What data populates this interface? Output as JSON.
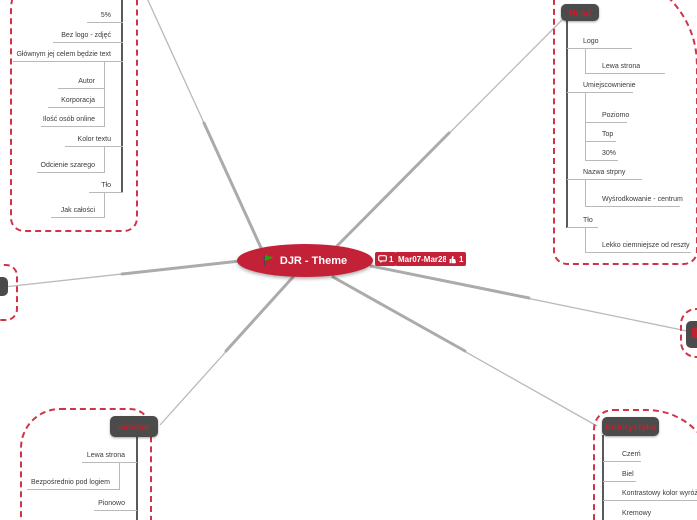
{
  "colors": {
    "accent_red": "#c32138",
    "node_header_bg": "#4b4b4b",
    "node_header_text": "#c3202f",
    "link_gray": "#b9b9b9",
    "dashed_border_red": "#d23349",
    "flag_green": "#2f9e0a"
  },
  "root": {
    "label": "DJR - Theme",
    "badges": {
      "comments_count": "1",
      "date_range": "Mar07-Mar28",
      "likes_count": "1"
    }
  },
  "boxes": {
    "top_left": {
      "items": [
        {
          "label": "5%"
        },
        {
          "label": "Bez logo - zdjęć"
        },
        {
          "label": "Głównym jej celem będzie text"
        },
        {
          "label": "Autor"
        },
        {
          "label": "Korporacja"
        },
        {
          "label": "Ilość osób online"
        },
        {
          "label": "Kolor textu"
        },
        {
          "label": "Odcienie szarego"
        },
        {
          "label": "Tło"
        },
        {
          "label": "Jak całości"
        }
      ]
    },
    "head": {
      "title": "Head",
      "items": [
        {
          "label": "Logo"
        },
        {
          "label": "Lewa strona"
        },
        {
          "label": "Umiejscownienie"
        },
        {
          "label": "Poziomo"
        },
        {
          "label": "Top"
        },
        {
          "label": "30%"
        },
        {
          "label": "Nazwa strpny"
        },
        {
          "label": "Wyśrodkowanie - centrum"
        },
        {
          "label": "Tło"
        },
        {
          "label": "Lekko ciemniejsze od reszty"
        }
      ]
    },
    "sidebar": {
      "title": "sidebar",
      "items": [
        {
          "label": "Lewa strona"
        },
        {
          "label": "Bezpośrednio pod logiem"
        },
        {
          "label": "Pionowo"
        }
      ]
    },
    "kolorystyka": {
      "title": "Kolorystyka",
      "items": [
        {
          "label": "Czerń"
        },
        {
          "label": "Biel"
        },
        {
          "label": "Kontrastowy kolor wyróżnia"
        },
        {
          "label": "Kremowy"
        }
      ]
    }
  }
}
